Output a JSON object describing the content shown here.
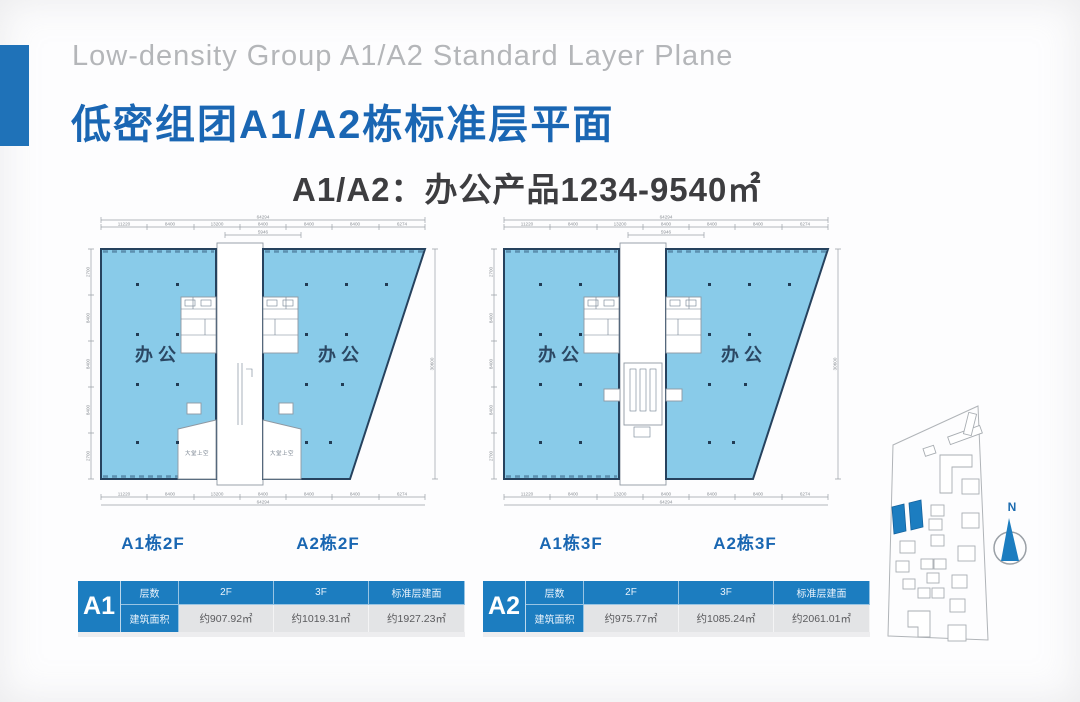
{
  "header": {
    "title_en": "Low-density Group A1/A2 Standard Layer Plane",
    "title_cn": "低密组团A1/A2栋标准层平面",
    "subtitle": "A1/A2：办公产品1234-9540㎡"
  },
  "plans": [
    {
      "label_left": "A1栋2F",
      "label_right": "A2栋2F",
      "zone": "办公",
      "lobby": "大堂上空",
      "dim_total_top": "64294",
      "dim_mid": "5946",
      "dims_top": [
        "11220",
        "8400",
        "13200",
        "8400",
        "8400",
        "8400",
        "6274"
      ],
      "dims_bottom": [
        "11220",
        "8400",
        "13200",
        "8400",
        "8400",
        "8400",
        "6274"
      ],
      "dim_total_bottom": "64294",
      "dims_left": [
        "2700",
        "8400",
        "8400",
        "8400",
        "2700"
      ],
      "dim_right": "30600"
    },
    {
      "label_left": "A1栋3F",
      "label_right": "A2栋3F",
      "zone": "办公",
      "dim_total_top": "64294",
      "dim_mid": "5946",
      "dims_top": [
        "11220",
        "8400",
        "13200",
        "8400",
        "8400",
        "8400",
        "6274"
      ],
      "dims_bottom": [
        "11220",
        "8400",
        "13200",
        "8400",
        "8400",
        "8400",
        "6274"
      ],
      "dim_total_bottom": "64294",
      "dims_left": [
        "2700",
        "8400",
        "8400",
        "8400",
        "2700"
      ],
      "dim_right": "30600"
    }
  ],
  "tables": [
    {
      "id": "A1",
      "headers": [
        "层数",
        "2F",
        "3F",
        "标准层建面"
      ],
      "row_label": "建筑面积",
      "values": [
        "约907.92㎡",
        "约1019.31㎡",
        "约1927.23㎡"
      ]
    },
    {
      "id": "A2",
      "headers": [
        "层数",
        "2F",
        "3F",
        "标准层建面"
      ],
      "row_label": "建筑面积",
      "values": [
        "约975.77㎡",
        "约1085.24㎡",
        "约2061.01㎡"
      ]
    }
  ],
  "sitemap": {
    "north": "N"
  },
  "colors": {
    "accent": "#1c7dc0",
    "title_blue": "#1a66b3",
    "plan_fill": "#89cbe9",
    "plan_stroke": "#26425e",
    "table_row": "#e3e4e6"
  }
}
